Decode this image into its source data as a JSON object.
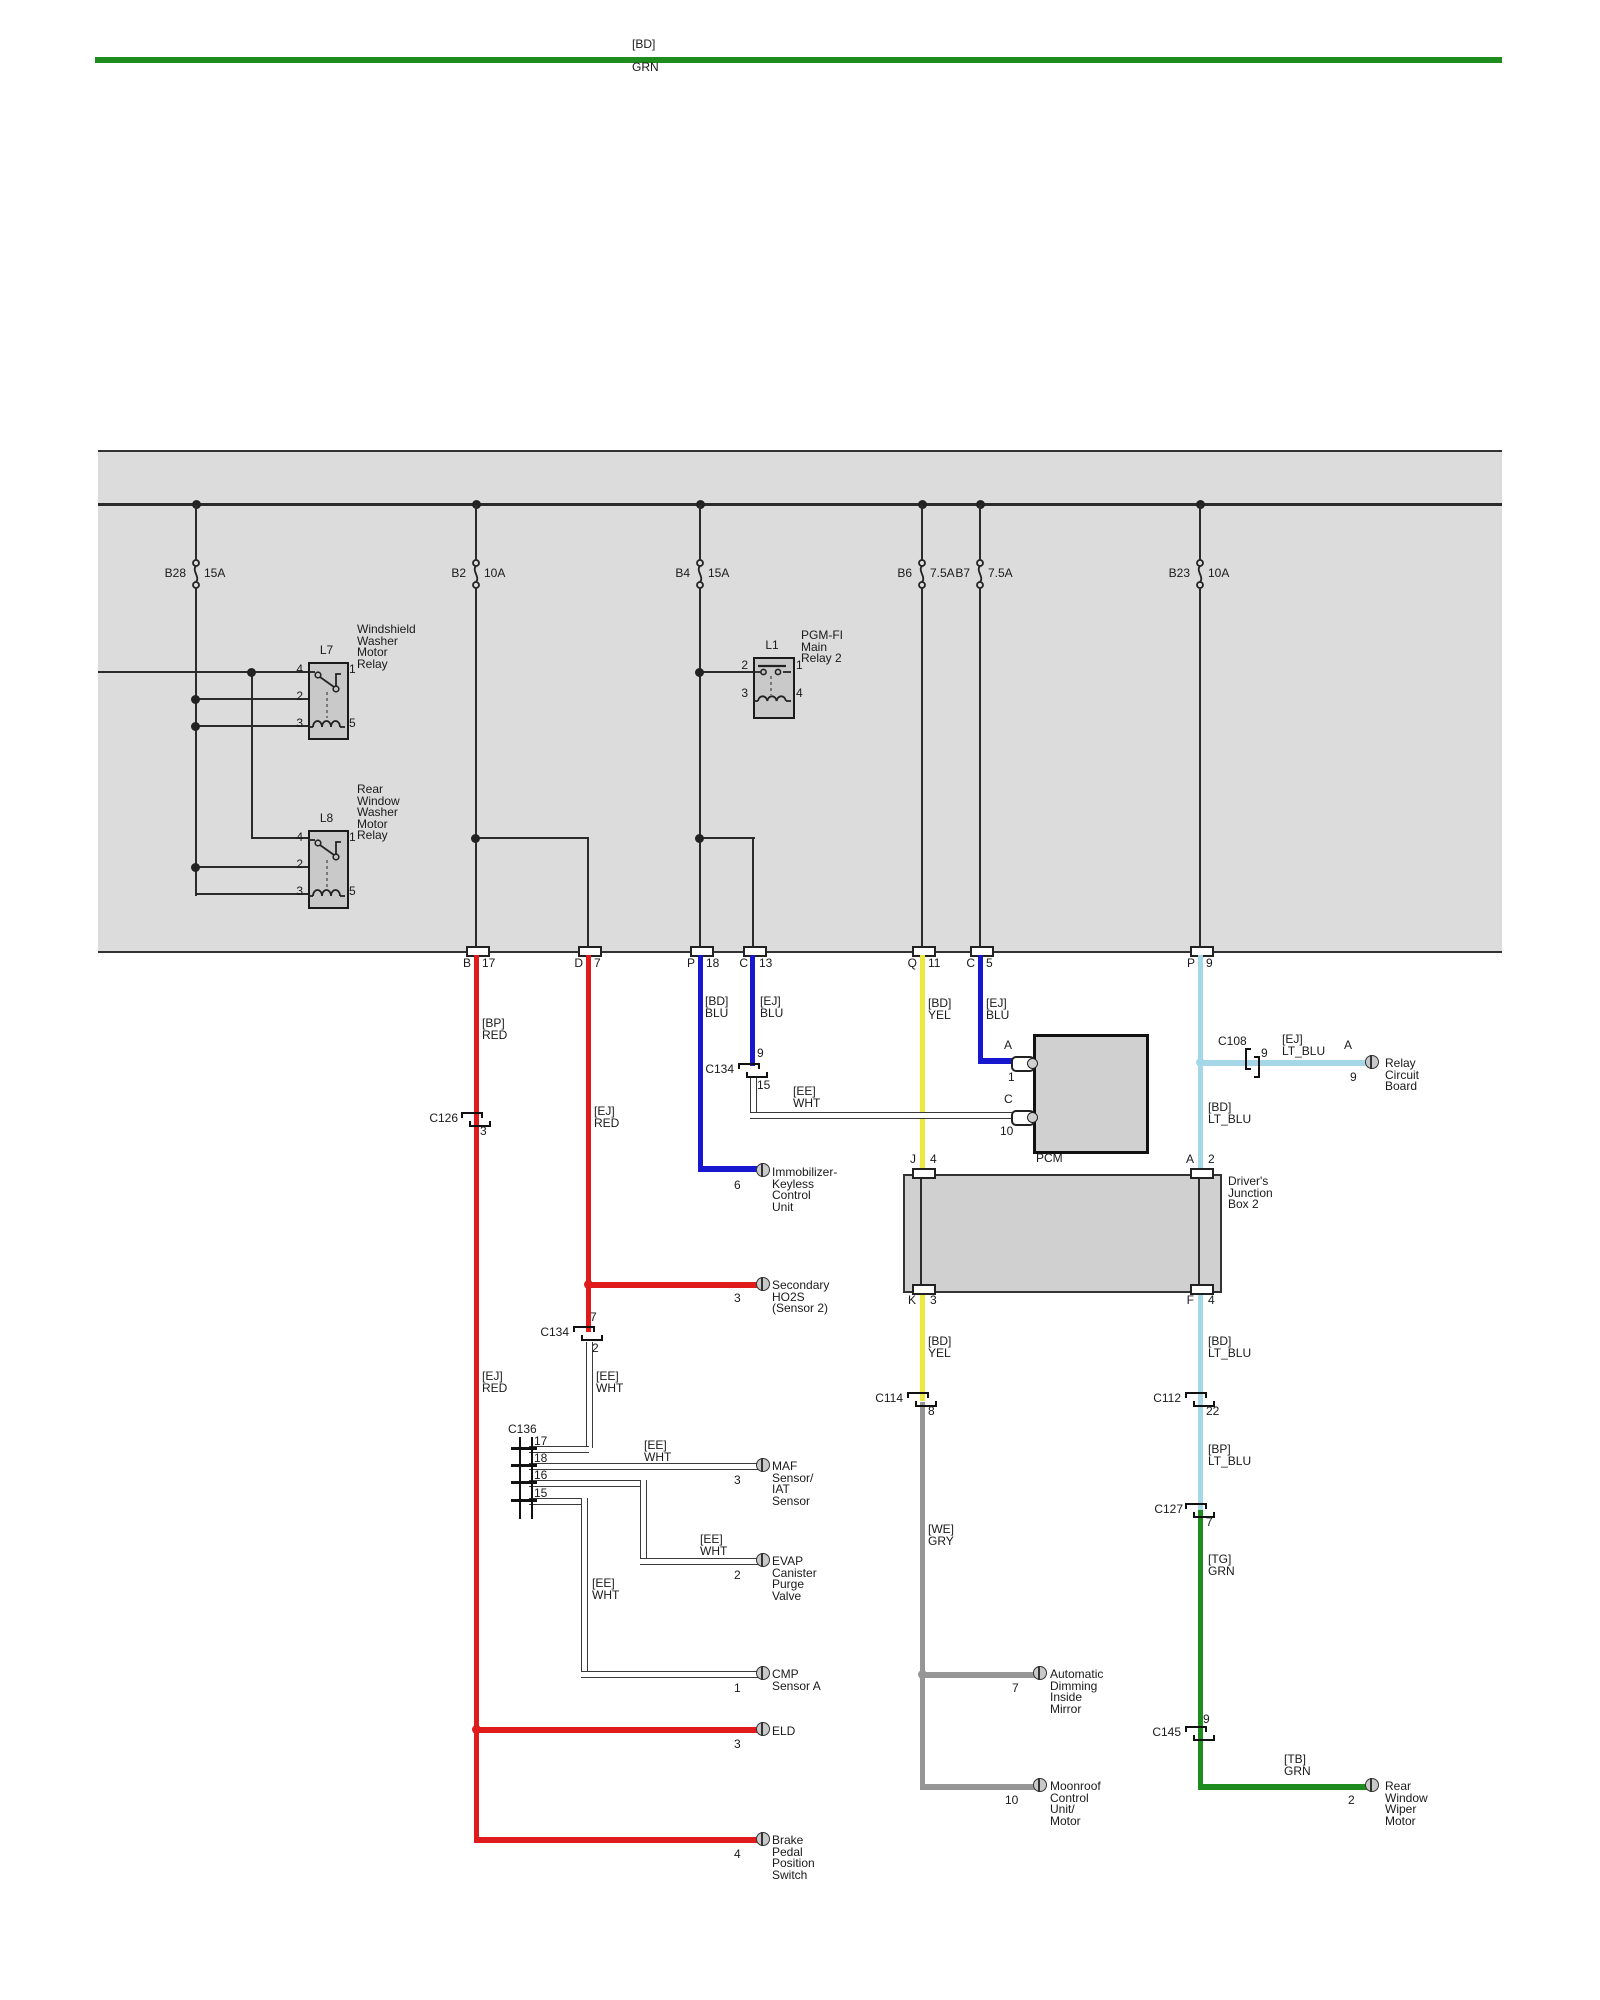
{
  "top_wire": {
    "tag": "[BD]",
    "color": "GRN"
  },
  "fuses": [
    {
      "id": "B28",
      "rating": "15A"
    },
    {
      "id": "B2",
      "rating": "10A"
    },
    {
      "id": "B4",
      "rating": "15A"
    },
    {
      "id": "B6",
      "rating": "7.5A"
    },
    {
      "id": "B7",
      "rating": "7.5A"
    },
    {
      "id": "B23",
      "rating": "10A"
    }
  ],
  "relays": {
    "l7": {
      "id": "L7",
      "name": "Windshield\nWasher\nMotor\nRelay",
      "p4": "4",
      "p1": "1",
      "p2": "2",
      "p3": "3",
      "p5": "5"
    },
    "l8": {
      "id": "L8",
      "name": "Rear\nWindow\nWasher\nMotor\nRelay",
      "p4": "4",
      "p1": "1",
      "p2": "2",
      "p3": "3",
      "p5": "5"
    },
    "l1": {
      "id": "L1",
      "name": "PGM-FI\nMain\nRelay 2",
      "p2": "2",
      "p1": "1",
      "p3": "3",
      "p4": "4"
    }
  },
  "exits": [
    {
      "letter": "B",
      "num": "17"
    },
    {
      "letter": "D",
      "num": "7"
    },
    {
      "letter": "P",
      "num": "18"
    },
    {
      "letter": "C",
      "num": "13"
    },
    {
      "letter": "Q",
      "num": "11"
    },
    {
      "letter": "C",
      "num": "5"
    },
    {
      "letter": "P",
      "num": "9"
    }
  ],
  "wire_labels": [
    {
      "tag": "[BP]",
      "color": "RED"
    },
    {
      "tag": "[EJ]",
      "color": "RED"
    },
    {
      "tag": "[BD]",
      "color": "BLU"
    },
    {
      "tag": "[EJ]",
      "color": "BLU"
    },
    {
      "tag": "[BD]",
      "color": "YEL"
    },
    {
      "tag": "[EJ]",
      "color": "BLU"
    },
    {
      "tag": "[EE]",
      "color": "WHT"
    },
    {
      "tag": "[EJ]",
      "color": "LT_BLU"
    },
    {
      "tag": "[BD]",
      "color": "LT_BLU"
    },
    {
      "tag": "[BD]",
      "color": "YEL"
    },
    {
      "tag": "[BD]",
      "color": "LT_BLU"
    },
    {
      "tag": "[EJ]",
      "color": "RED"
    },
    {
      "tag": "[EE]",
      "color": "WHT"
    },
    {
      "tag": "[EE]",
      "color": "WHT"
    },
    {
      "tag": "[EE]",
      "color": "WHT"
    },
    {
      "tag": "[EE]",
      "color": "WHT"
    },
    {
      "tag": "[WE]",
      "color": "GRY"
    },
    {
      "tag": "[BP]",
      "color": "LT_BLU"
    },
    {
      "tag": "[TG]",
      "color": "GRN"
    },
    {
      "tag": "[TB]",
      "color": "GRN"
    }
  ],
  "connectors": {
    "c126": {
      "name": "C126",
      "pin": "3"
    },
    "c134_pcm": {
      "name": "C134",
      "pin_top": "9",
      "pin_bottom": "15"
    },
    "c134_eng": {
      "name": "C134",
      "pin_top": "7",
      "pin_bottom": "2"
    },
    "c136": {
      "name": "C136",
      "pins": [
        "17",
        "18",
        "16",
        "15"
      ]
    },
    "c108": {
      "name": "C108",
      "pin": "9"
    },
    "c114": {
      "name": "C114",
      "pin": "8"
    },
    "c112": {
      "name": "C112",
      "pin": "22"
    },
    "c127": {
      "name": "C127",
      "pin": "7"
    },
    "c145": {
      "name": "C145",
      "pin": "9"
    }
  },
  "pcm": {
    "name": "PCM",
    "pin_a": {
      "letter": "A",
      "num": "1"
    },
    "pin_c": {
      "letter": "C",
      "num": "10"
    }
  },
  "junction_box": {
    "name": "Driver's\nJunction\nBox 2",
    "j": {
      "letter": "J",
      "num": "4"
    },
    "a": {
      "letter": "A",
      "num": "2"
    },
    "k": {
      "letter": "K",
      "num": "3"
    },
    "f": {
      "letter": "F",
      "num": "4"
    }
  },
  "components": {
    "immobilizer": {
      "name": "Immobilizer-\nKeyless\nControl\nUnit",
      "pin": "6"
    },
    "ho2s": {
      "name": "Secondary\nHO2S\n(Sensor 2)",
      "pin": "3"
    },
    "maf": {
      "name": "MAF\nSensor/\nIAT\nSensor",
      "pin": "3"
    },
    "evap": {
      "name": "EVAP\nCanister\nPurge\nValve",
      "pin": "2"
    },
    "cmp": {
      "name": "CMP\nSensor A",
      "pin": "1"
    },
    "eld": {
      "name": "ELD",
      "pin": "3"
    },
    "brake": {
      "name": "Brake\nPedal\nPosition\nSwitch",
      "pin": "4"
    },
    "mirror": {
      "name": "Automatic\nDimming\nInside\nMirror",
      "pin": "7"
    },
    "moonroof": {
      "name": "Moonroof\nControl\nUnit/\nMotor",
      "pin": "10"
    },
    "relay_board": {
      "name": "Relay\nCircuit\nBoard",
      "letter": "A",
      "pin": "9"
    },
    "rear_wiper": {
      "name": "Rear\nWindow\nWiper\nMotor",
      "pin": "2"
    }
  },
  "colors": {
    "red": "#df1b1b",
    "blue": "#1717cf",
    "yellow": "#ece93c",
    "light_blue": "#a6d7e8",
    "green": "#1f8c1f",
    "gray": "#969696",
    "white_wire": "#ffffff",
    "diagram_line": "#2b2b2b",
    "fusebox_fill": "#dcdcdc",
    "component_fill": "#d0d0d0"
  }
}
